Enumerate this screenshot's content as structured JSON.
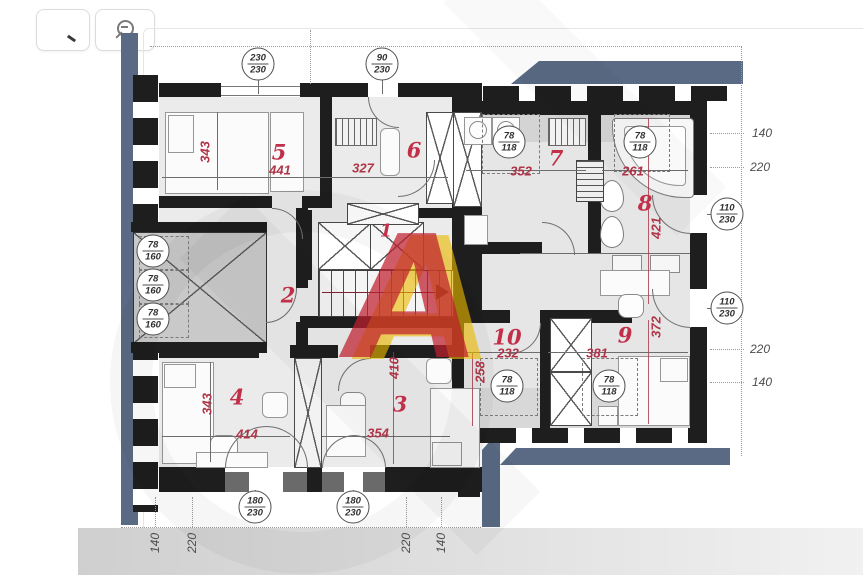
{
  "toolbar": {
    "buttons": [
      {
        "icon": "zoom-in-icon"
      },
      {
        "icon": "zoom-out-icon"
      }
    ]
  },
  "plan": {
    "rooms": [
      {
        "number": "1"
      },
      {
        "number": "2"
      },
      {
        "number": "3",
        "dim_w": "354",
        "dim_h": "410"
      },
      {
        "number": "4",
        "dim_w": "414",
        "dim_h": "343"
      },
      {
        "number": "5",
        "dim_w": "441",
        "dim_h": "343"
      },
      {
        "number": "6",
        "dim_w": "327"
      },
      {
        "number": "7",
        "dim_w": "352"
      },
      {
        "number": "8",
        "dim_w": "261",
        "dim_h": "421"
      },
      {
        "number": "9",
        "dim_w": "381",
        "dim_h": "372"
      },
      {
        "number": "10",
        "dim_w": "232",
        "dim_h": "258"
      }
    ],
    "openings": [
      {
        "top": "230",
        "bottom": "230"
      },
      {
        "top": "90",
        "bottom": "230"
      },
      {
        "top": "78",
        "bottom": "118"
      },
      {
        "top": "78",
        "bottom": "118"
      },
      {
        "top": "78",
        "bottom": "160"
      },
      {
        "top": "78",
        "bottom": "160"
      },
      {
        "top": "78",
        "bottom": "160"
      },
      {
        "top": "110",
        "bottom": "230"
      },
      {
        "top": "110",
        "bottom": "230"
      },
      {
        "top": "78",
        "bottom": "118"
      },
      {
        "top": "78",
        "bottom": "118"
      },
      {
        "top": "180",
        "bottom": "230"
      },
      {
        "top": "180",
        "bottom": "230"
      }
    ],
    "edge_dims": {
      "right": [
        "140",
        "220",
        "220",
        "140"
      ],
      "bottom": [
        "140",
        "220",
        "220",
        "140"
      ]
    },
    "watermark": {
      "letter": "A"
    },
    "colors": {
      "roof_band": "#5a6a84",
      "wall": "#1e1e1e",
      "dim_text": "#b03448",
      "room_fill": "#ebebeb"
    }
  }
}
